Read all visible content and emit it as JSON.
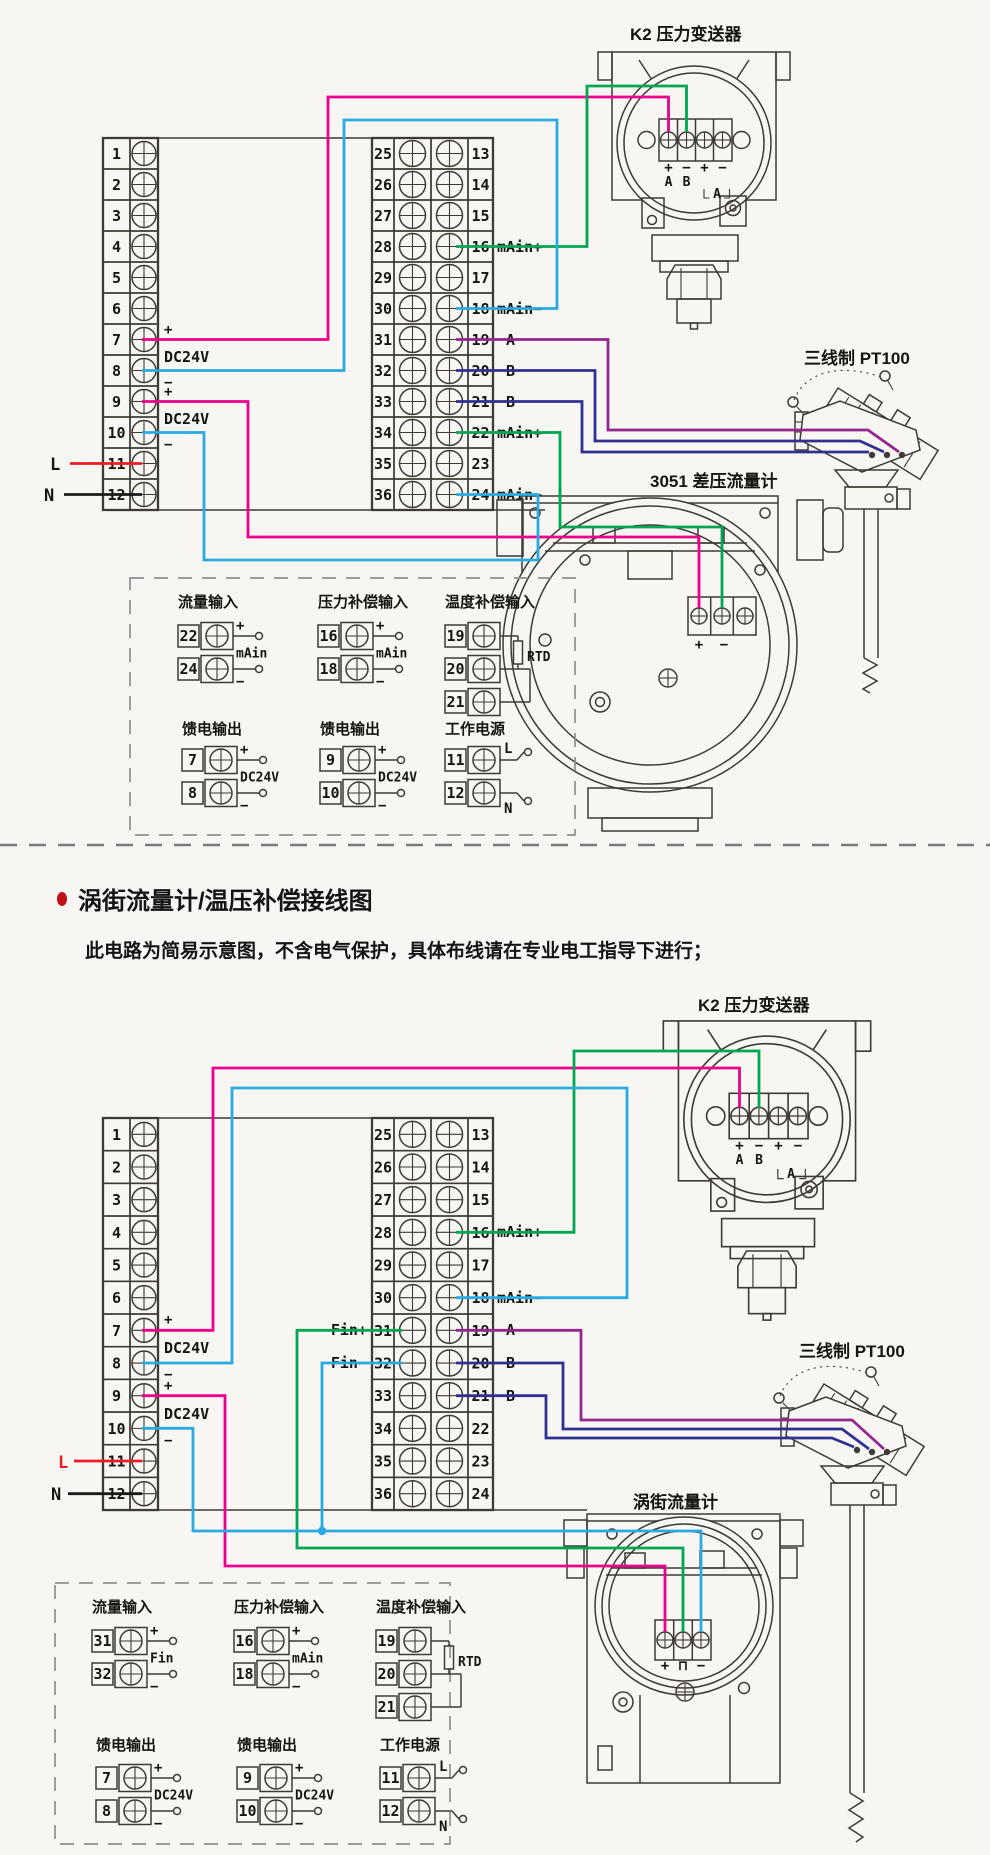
{
  "colors": {
    "background": "#f7f6f3",
    "line_art": "#3f3a35",
    "wire_pink": "#ec008c",
    "wire_cyan": "#29abe2",
    "wire_green": "#00a651",
    "wire_purple": "#93278f",
    "wire_blue": "#2e3192",
    "wire_red": "#ed1c24",
    "title_red": "#c1121c"
  },
  "header": {
    "title": "涡街流量计/温压补偿接线图",
    "note": "此电路为简易示意图，不含电气保护，具体布线请在专业电工指导下进行；"
  },
  "strips": {
    "left_numbers": [
      "1",
      "2",
      "3",
      "4",
      "5",
      "6",
      "7",
      "8",
      "9",
      "10",
      "11",
      "12"
    ],
    "mid_left_numbers": [
      "25",
      "26",
      "27",
      "28",
      "29",
      "30",
      "31",
      "32",
      "33",
      "34",
      "35",
      "36"
    ],
    "mid_right_numbers": [
      "13",
      "14",
      "15",
      "16",
      "17",
      "18",
      "19",
      "20",
      "21",
      "22",
      "23",
      "24"
    ]
  },
  "diagram1": {
    "k2": {
      "label": "K2 压力变送器",
      "signs": [
        "+",
        "−",
        "+",
        "−"
      ],
      "letters": [
        "A",
        "B"
      ],
      "loop": "A"
    },
    "pt100_label": "三线制 PT100",
    "meter": {
      "label": "3051 差压流量计",
      "signs": [
        "+",
        "−"
      ]
    },
    "left_ann": [
      "+",
      "DC24V",
      "−",
      "+",
      "DC24V",
      "−"
    ],
    "mains": {
      "l": "L",
      "n": "N"
    },
    "mid_right_labels": [
      "mAin+",
      "mAin−",
      "A",
      "B",
      "B",
      "mAin+",
      "mAin−"
    ],
    "legend": {
      "cells": [
        {
          "title": "流量输入",
          "rows": [
            {
              "n": "22",
              "sign": "+"
            },
            {
              "n": "24",
              "sign": "−"
            }
          ],
          "tag": "mAin"
        },
        {
          "title": "压力补偿输入",
          "rows": [
            {
              "n": "16",
              "sign": "+"
            },
            {
              "n": "18",
              "sign": "−"
            }
          ],
          "tag": "mAin"
        },
        {
          "title": "温度补偿输入",
          "rows": [
            {
              "n": "19"
            },
            {
              "n": "20"
            },
            {
              "n": "21"
            }
          ],
          "tag": "RTD"
        },
        {
          "title": "馈电输出",
          "rows": [
            {
              "n": "7",
              "sign": "+"
            },
            {
              "n": "8",
              "sign": "−"
            }
          ],
          "tag": "DC24V"
        },
        {
          "title": "馈电输出",
          "rows": [
            {
              "n": "9",
              "sign": "+"
            },
            {
              "n": "10",
              "sign": "−"
            }
          ],
          "tag": "DC24V"
        },
        {
          "title": "工作电源",
          "rows": [
            {
              "n": "11",
              "sign": "L"
            },
            {
              "n": "12",
              "sign": "N"
            }
          ],
          "tag": ""
        }
      ]
    }
  },
  "diagram2": {
    "k2": {
      "label": "K2 压力变送器",
      "signs": [
        "+",
        "−",
        "+",
        "−"
      ],
      "letters": [
        "A",
        "B"
      ],
      "loop": "A"
    },
    "pt100_label": "三线制 PT100",
    "meter": {
      "label": "涡街流量计",
      "signs": [
        "+",
        "⊓",
        "−"
      ]
    },
    "left_ann": [
      "+",
      "DC24V",
      "−",
      "+",
      "DC24V",
      "−"
    ],
    "mains": {
      "l": "L",
      "n": "N"
    },
    "mid_left_labels": [
      "Fin+",
      "Fin−"
    ],
    "mid_right_labels": [
      "mAin+",
      "mAin−",
      "A",
      "B",
      "B"
    ],
    "legend": {
      "cells": [
        {
          "title": "流量输入",
          "rows": [
            {
              "n": "31",
              "sign": "+"
            },
            {
              "n": "32",
              "sign": "−"
            }
          ],
          "tag": "Fin"
        },
        {
          "title": "压力补偿输入",
          "rows": [
            {
              "n": "16",
              "sign": "+"
            },
            {
              "n": "18",
              "sign": "−"
            }
          ],
          "tag": "mAin"
        },
        {
          "title": "温度补偿输入",
          "rows": [
            {
              "n": "19"
            },
            {
              "n": "20"
            },
            {
              "n": "21"
            }
          ],
          "tag": "RTD"
        },
        {
          "title": "馈电输出",
          "rows": [
            {
              "n": "7",
              "sign": "+"
            },
            {
              "n": "8",
              "sign": "−"
            }
          ],
          "tag": "DC24V"
        },
        {
          "title": "馈电输出",
          "rows": [
            {
              "n": "9",
              "sign": "+"
            },
            {
              "n": "10",
              "sign": "−"
            }
          ],
          "tag": "DC24V"
        },
        {
          "title": "工作电源",
          "rows": [
            {
              "n": "11",
              "sign": "L"
            },
            {
              "n": "12",
              "sign": "N"
            }
          ],
          "tag": ""
        }
      ]
    }
  }
}
